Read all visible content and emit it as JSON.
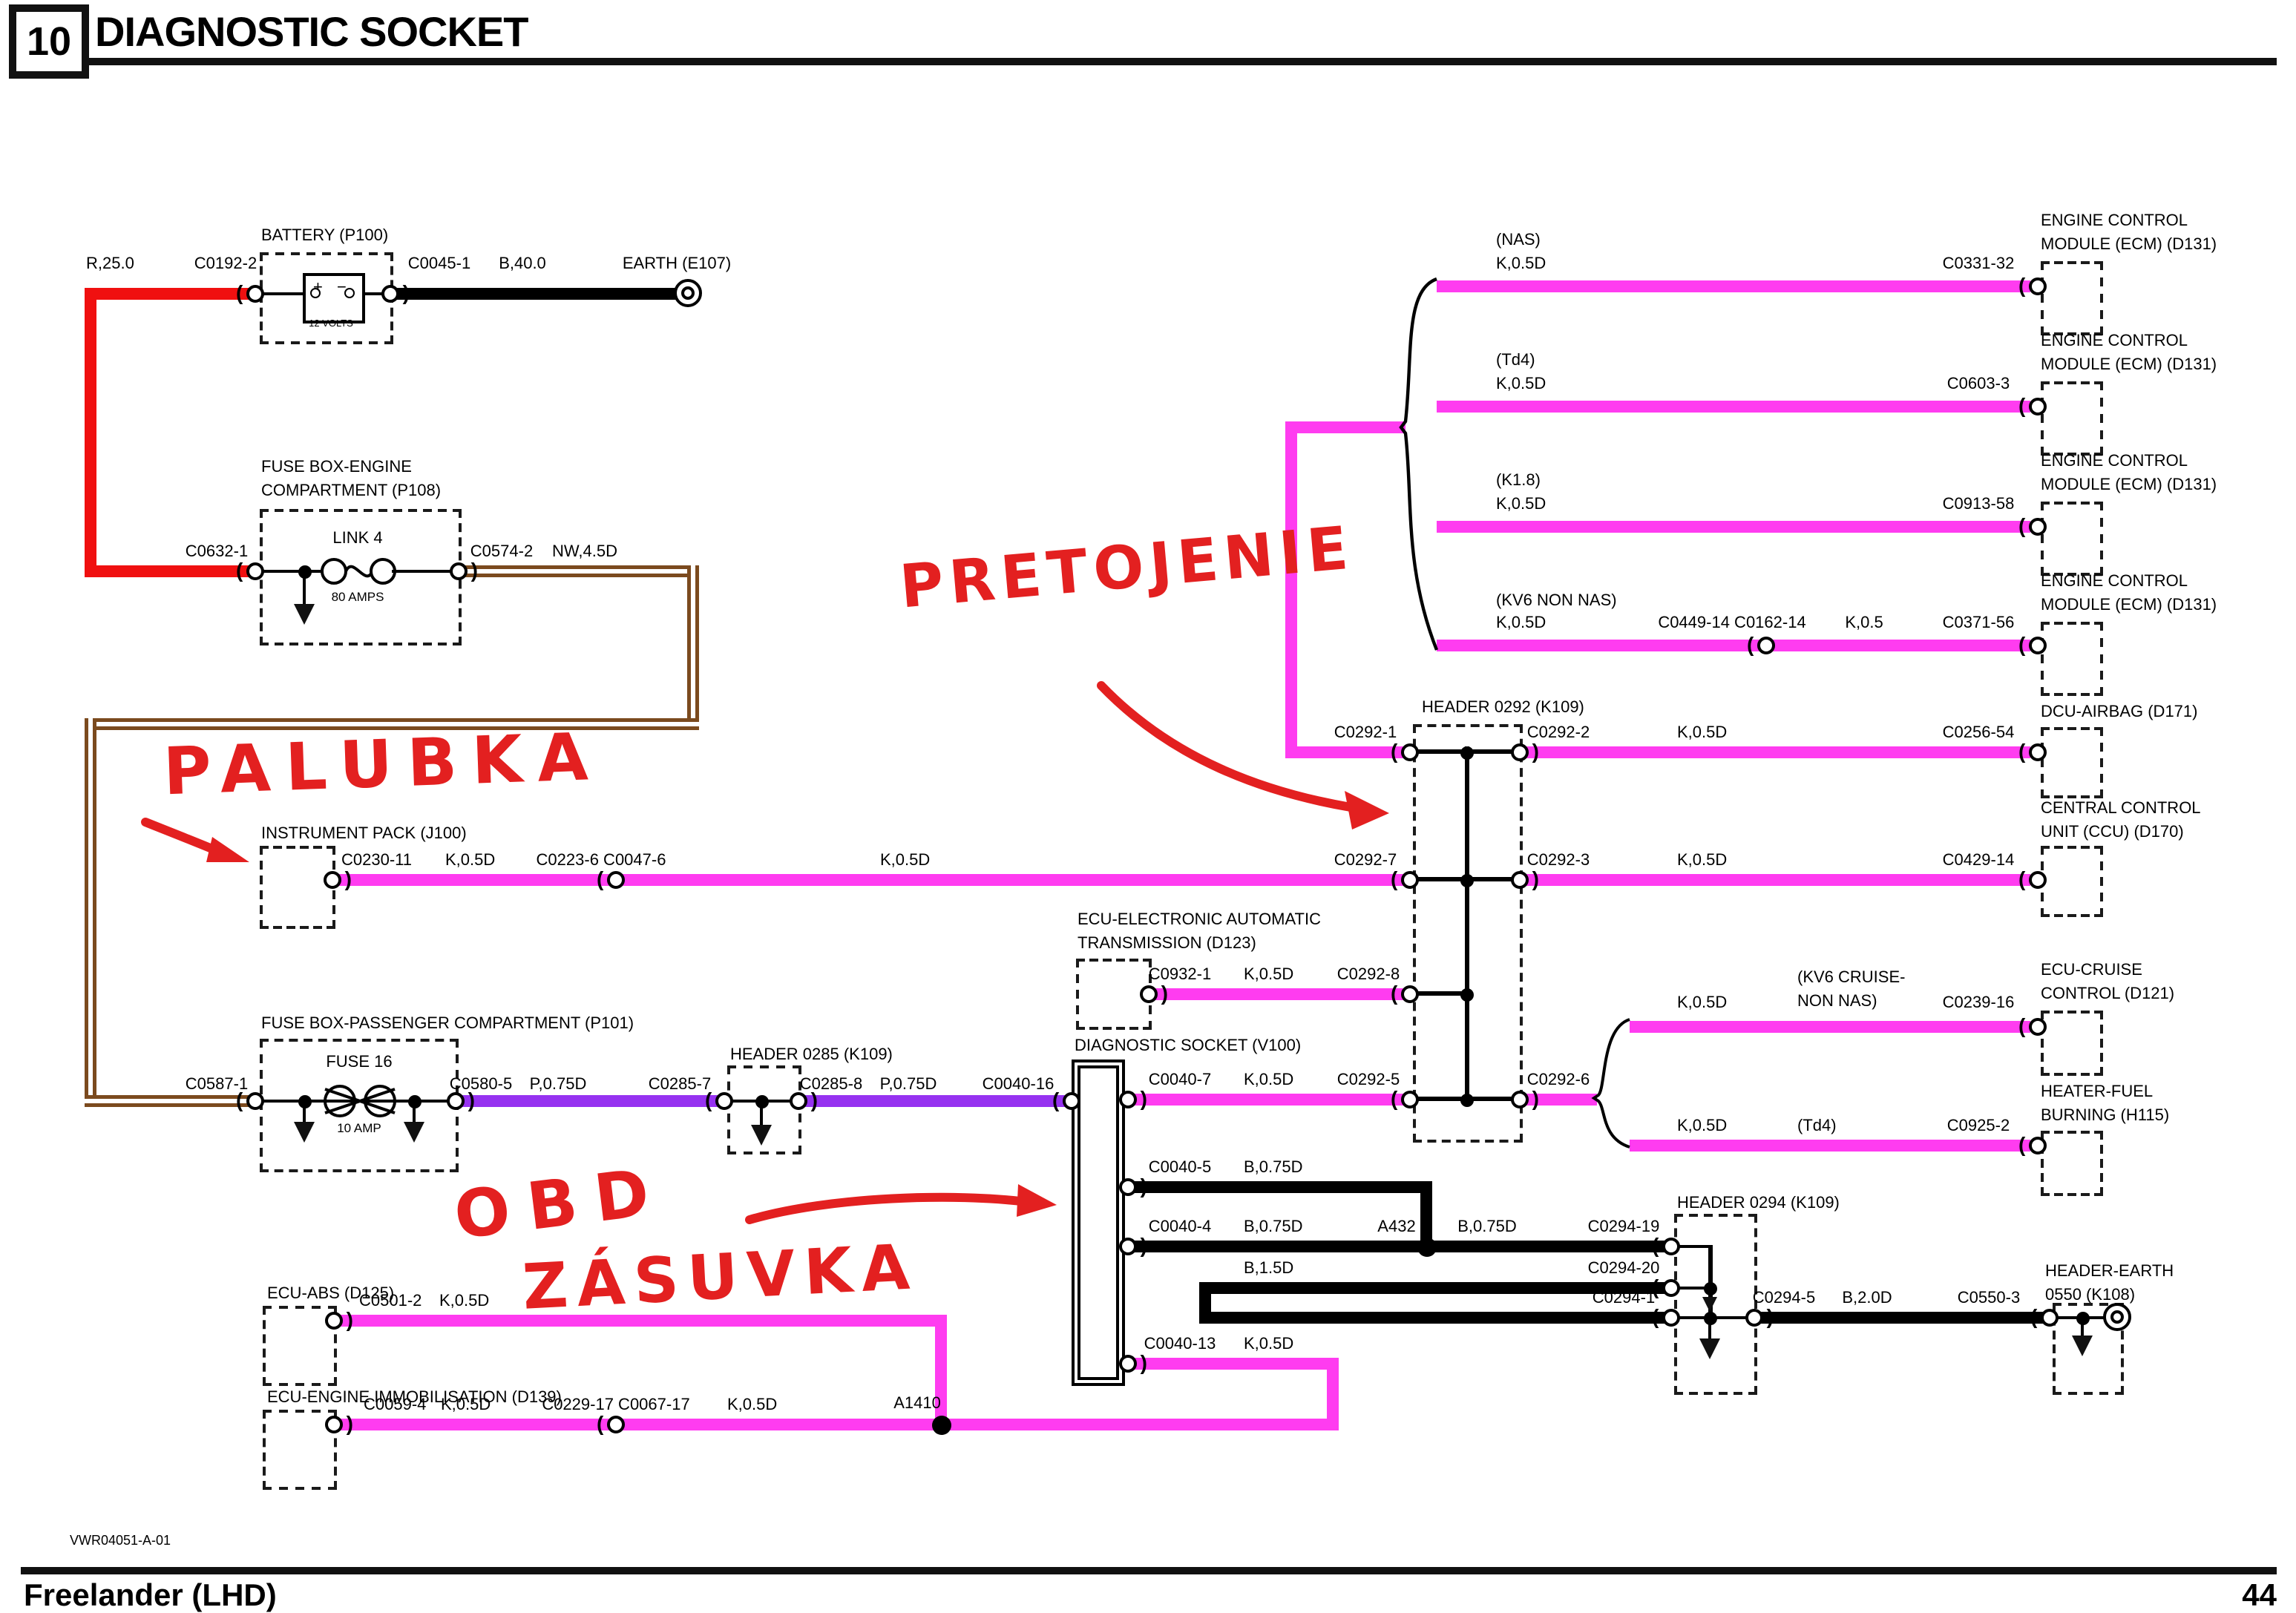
{
  "header": {
    "num": "10",
    "title": "DIAGNOSTIC SOCKET"
  },
  "battery": {
    "name": "BATTERY (P100)",
    "wire_in": "R,25.0",
    "conn_in": "C0192-2",
    "conn_out": "C0045-1",
    "wire_out": "B,40.0",
    "earth": "EARTH (E107)",
    "plus": "+",
    "minus": "−",
    "volts": "12 VOLTS"
  },
  "fusebox_engine": {
    "name1": "FUSE BOX-ENGINE",
    "name2": "COMPARTMENT (P108)",
    "conn_in": "C0632-1",
    "link": "LINK 4",
    "amps": "80 AMPS",
    "conn_out": "C0574-2",
    "wire_out": "NW,4.5D"
  },
  "ecm": {
    "label1": "ENGINE CONTROL",
    "label2": "MODULE (ECM) (D131)",
    "rows": [
      {
        "variant": "(NAS)",
        "wire": "K,0.5D",
        "conn": "C0331-32"
      },
      {
        "variant": "(Td4)",
        "wire": "K,0.5D",
        "conn": "C0603-3"
      },
      {
        "variant": "(K1.8)",
        "wire": "K,0.5D",
        "conn": "C0913-58"
      },
      {
        "variant": "(KV6 NON NAS)",
        "wire": "K,0.5D",
        "inline_conn": "C0449-14 C0162-14",
        "wire2": "K,0.5",
        "conn": "C0371-56"
      }
    ]
  },
  "header0292": {
    "name": "HEADER 0292 (K109)",
    "c1": "C0292-1",
    "c2": "C0292-2",
    "c7": "C0292-7",
    "c3": "C0292-3",
    "c8": "C0292-8",
    "c5": "C0292-5",
    "c6": "C0292-6"
  },
  "dcu": {
    "name": "DCU-AIRBAG (D171)",
    "wire": "K,0.5D",
    "conn": "C0256-54"
  },
  "ccu": {
    "name1": "CENTRAL CONTROL",
    "name2": "UNIT (CCU) (D170)",
    "wire": "K,0.5D",
    "conn": "C0429-14"
  },
  "instrument": {
    "name": "INSTRUMENT PACK (J100)",
    "conn": "C0230-11",
    "wire": "K,0.5D",
    "inline": "C0223-6 C0047-6",
    "wire2": "K,0.5D"
  },
  "ecu_trans": {
    "name1": "ECU-ELECTRONIC AUTOMATIC",
    "name2": "TRANSMISSION (D123)",
    "conn": "C0932-1",
    "wire": "K,0.5D",
    "to": "C0292-8"
  },
  "fusebox_pass": {
    "name": "FUSE BOX-PASSENGER COMPARTMENT (P101)",
    "conn_in": "C0587-1",
    "fuse": "FUSE 16",
    "amp": "10 AMP",
    "conn_out": "C0580-5",
    "wire": "P,0.75D"
  },
  "header0285": {
    "name": "HEADER 0285 (K109)",
    "conn_in": "C0285-7",
    "conn_out": "C0285-8",
    "wire": "P,0.75D",
    "to_socket": "C0040-16"
  },
  "socket": {
    "name": "DIAGNOSTIC SOCKET (V100)",
    "p7": "C0040-7",
    "p7_wire": "K,0.5D",
    "p7_to": "C0292-5",
    "p5": "C0040-5",
    "p5_wire": "B,0.75D",
    "p4": "C0040-4",
    "p4_wire": "B,0.75D",
    "splice": "A432",
    "p4_wire2": "B,0.75D",
    "p4_to": "C0294-19",
    "loop_wire": "B,1.5D",
    "loop_to": "C0294-20",
    "loop_to2": "C0294-1",
    "p13": "C0040-13",
    "p13_wire": "K,0.5D"
  },
  "cruise": {
    "wire": "K,0.5D",
    "variant1": "(KV6 CRUISE-",
    "variant2": "NON NAS)",
    "conn": "C0239-16",
    "name1": "ECU-CRUISE",
    "name2": "CONTROL (D121)"
  },
  "heater": {
    "wire": "K,0.5D",
    "variant": "(Td4)",
    "conn": "C0925-2",
    "name1": "HEATER-FUEL",
    "name2": "BURNING (H115)"
  },
  "header0294": {
    "name": "HEADER 0294 (K109)",
    "out": "C0294-5",
    "wire": "B,2.0D",
    "conn": "C0550-3"
  },
  "header_earth": {
    "name1": "HEADER-EARTH",
    "name2": "0550 (K108)"
  },
  "abs": {
    "name": "ECU-ABS (D125)",
    "conn": "C0501-2",
    "wire": "K,0.5D"
  },
  "immob": {
    "name": "ECU-ENGINE IMMOBILISATION (D139)",
    "conn": "C0059-4",
    "wire": "K,0.5D",
    "inline": "C0229-17 C0067-17",
    "wire2": "K,0.5D",
    "splice": "A1410"
  },
  "annotations": {
    "note_top": "PRETOJENIE",
    "note_left": "PALUBKA",
    "note_obd1": "OBD",
    "note_obd2": "ZÁSUVKA"
  },
  "footer": {
    "ref": "VWR04051-A-01",
    "model": "Freelander (LHD)",
    "page": "44"
  },
  "colors": {
    "k_pink": "#FF3CF0",
    "p_purple": "#9632F0",
    "r_red": "#F01010",
    "n_brown": "#7B4A1E",
    "b_black": "#000000",
    "annotation_red": "#E32020"
  }
}
